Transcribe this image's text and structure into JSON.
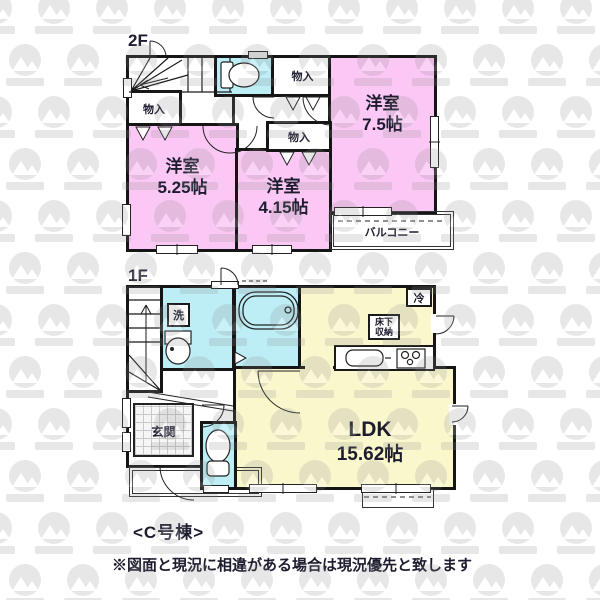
{
  "floor2": {
    "label": "2F",
    "rooms": [
      {
        "name": "洋室",
        "size": "7.5帖"
      },
      {
        "name": "洋室",
        "size": "5.25帖"
      },
      {
        "name": "洋室",
        "size": "4.15帖"
      }
    ],
    "closet_top": "物入",
    "closet_left": "物入",
    "closet_mid": "物入",
    "balcony": "バルコニー"
  },
  "floor1": {
    "label": "1F",
    "ldk": {
      "name": "LDK",
      "size": "15.62帖"
    },
    "entrance": "玄関",
    "washer": "洗",
    "fridge": "冷",
    "underfloor_line1": "床下",
    "underfloor_line2": "収納"
  },
  "footer": {
    "building": "<C号棟>",
    "disclaimer": "※図面と現況に相違がある場合は現況優先と致します"
  },
  "colors": {
    "room_pink": "#fbc7f5",
    "water_cyan": "#bdeef6",
    "ldk_yellow": "#faf7cd",
    "wall": "#151515",
    "text": "#1c1c2e"
  },
  "icons": [
    "stairs",
    "toilet",
    "bathtub",
    "vanity-sink",
    "kitchen-sink",
    "stove",
    "door-arc",
    "watermark-badge"
  ]
}
